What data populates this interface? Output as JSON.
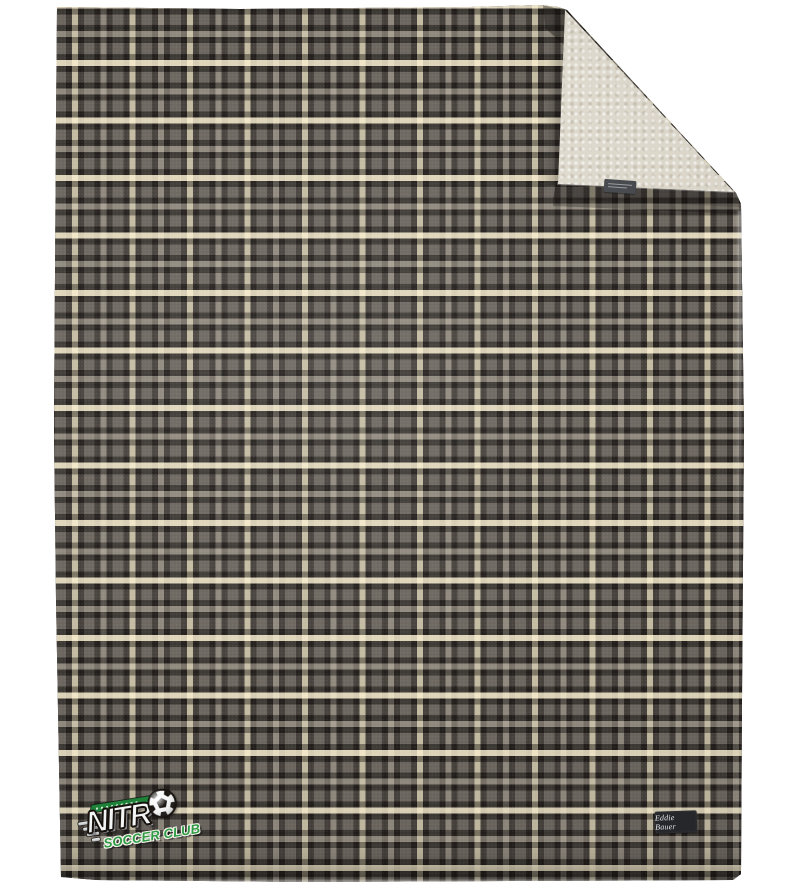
{
  "scene": {
    "type": "product-photo",
    "background_color": "#ffffff",
    "subject": "Gray plaid fleece blanket with cream sherpa lining shown at the folded top-right corner"
  },
  "blanket": {
    "plaid_colors": {
      "base_gray": "#6b665f",
      "dark_band": "#36312d",
      "cream_stripe": "#e9dfbe",
      "pale_stripe": "#9d968a"
    },
    "plaid_repeat_px": 57.5,
    "sherpa_color": "#e4dfd2",
    "care_tag_color": "#46494d"
  },
  "logo": {
    "title": "NITRO",
    "title_display": "NITR",
    "ball_icon": "soccer-ball",
    "subtitle": "SOCCER CLUB",
    "subtitle_color": "#2e9b43",
    "banner_color": "#1e8238",
    "title_color": "#f3f4f4"
  },
  "brand_patch": {
    "label": "Eddie Bauer",
    "background": "#26272a",
    "text_color": "#e6e7e9"
  }
}
